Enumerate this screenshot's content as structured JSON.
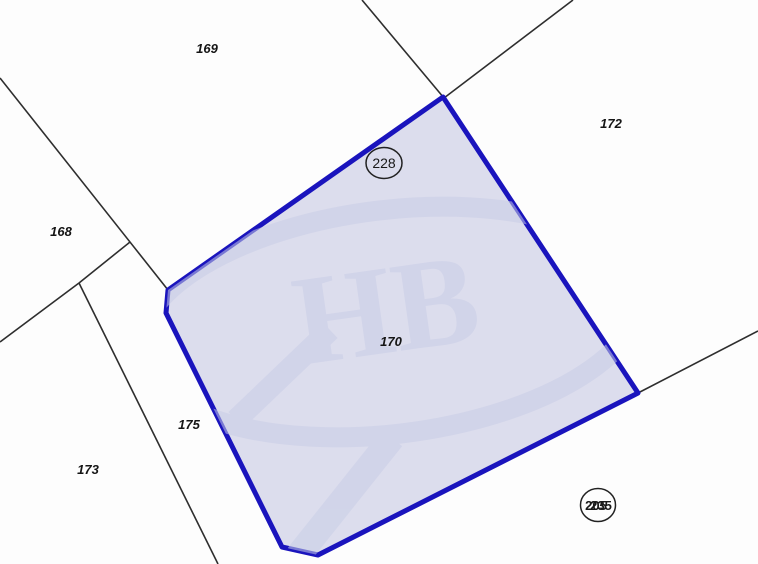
{
  "map": {
    "type": "cadastral-parcel-map",
    "highlighted_parcel": {
      "label": "170",
      "fill_color": "#dcdded",
      "border_color": "#1a14bd"
    },
    "parcel_labels": [
      {
        "text": "169"
      },
      {
        "text": "172"
      },
      {
        "text": "168"
      },
      {
        "text": "175"
      },
      {
        "text": "173"
      },
      {
        "text": "170"
      }
    ],
    "circled_labels": [
      {
        "text": "228"
      },
      {
        "text": "205"
      },
      {
        "text": "235"
      }
    ],
    "watermark_text": "НВ",
    "background_color": "#fdfdfd",
    "boundary_line_color": "#2e2e2e"
  }
}
